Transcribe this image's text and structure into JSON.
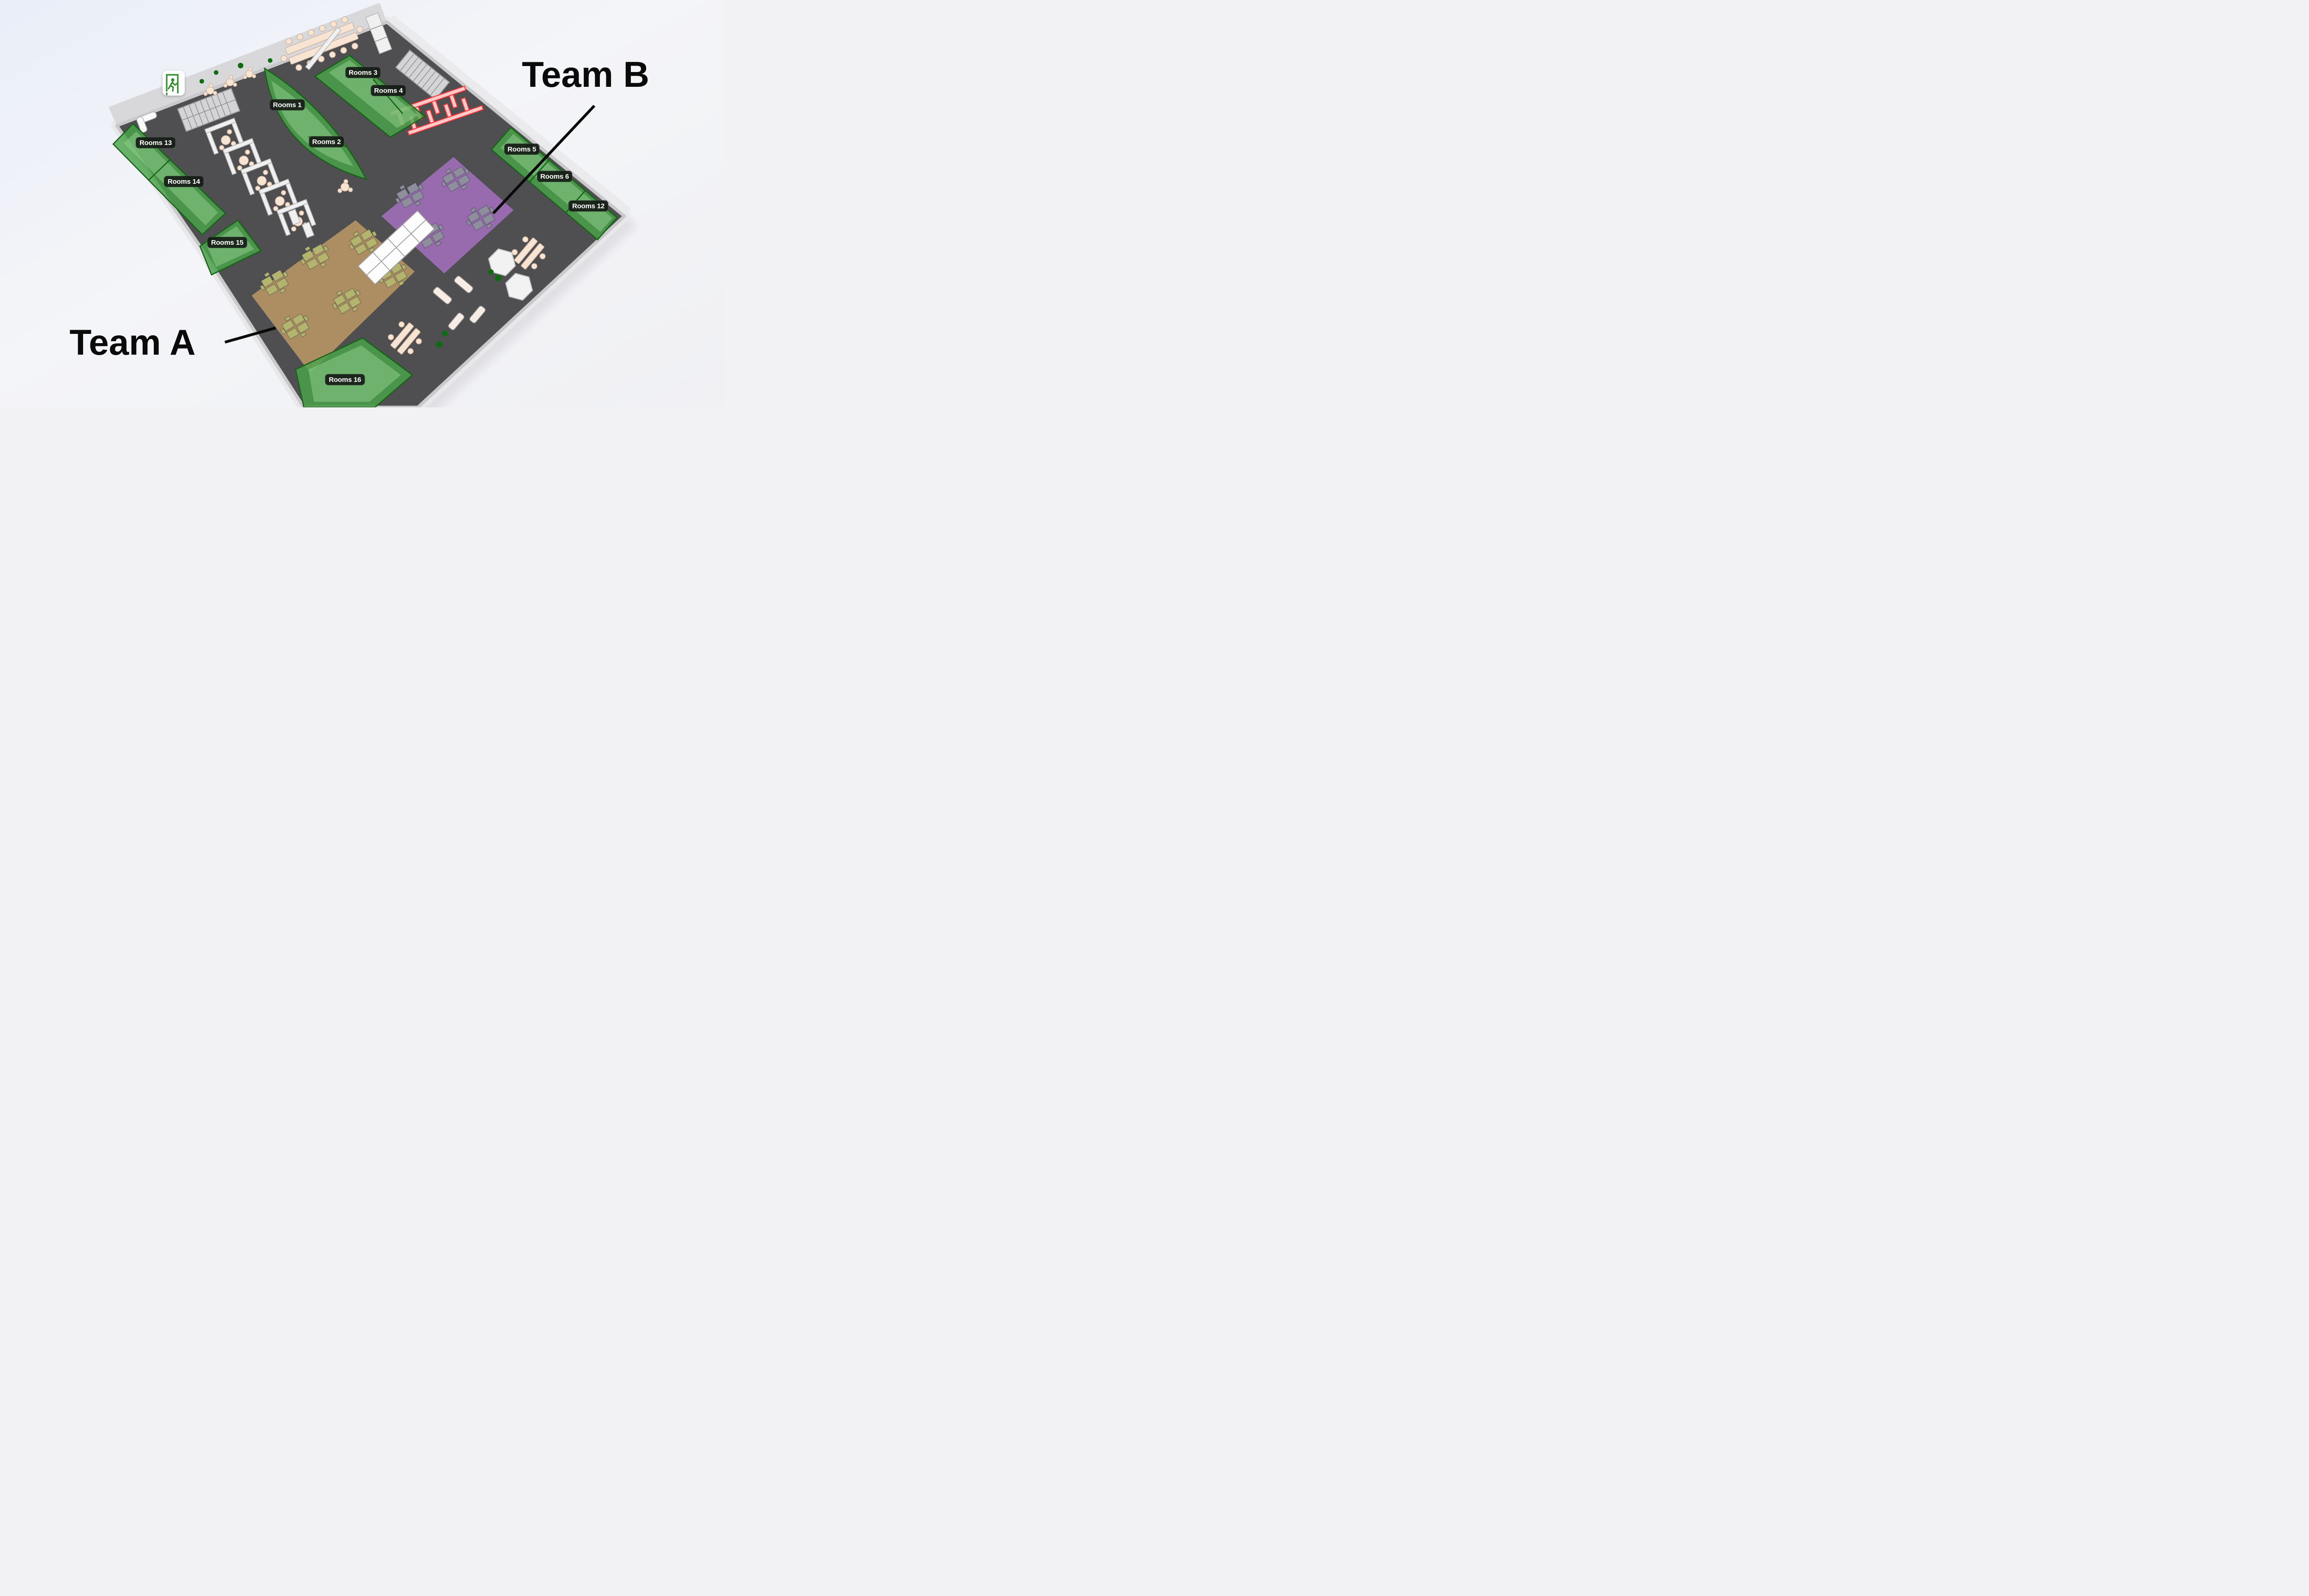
{
  "scene": {
    "title": "3D office floor plan",
    "view": "isometric"
  },
  "teams": {
    "a": {
      "label": "Team A"
    },
    "b": {
      "label": "Team B"
    }
  },
  "rooms": {
    "r1": {
      "label": "Rooms 1"
    },
    "r2": {
      "label": "Rooms 2"
    },
    "r3": {
      "label": "Rooms 3"
    },
    "r4": {
      "label": "Rooms 4"
    },
    "r5": {
      "label": "Rooms 5"
    },
    "r6": {
      "label": "Rooms 6"
    },
    "r12": {
      "label": "Rooms 12"
    },
    "r13": {
      "label": "Rooms 13"
    },
    "r14": {
      "label": "Rooms 14"
    },
    "r15": {
      "label": "Rooms 15"
    },
    "r16": {
      "label": "Rooms 16"
    }
  },
  "icons": {
    "exit": "emergency-exit-icon"
  },
  "colors": {
    "floor": "#4f4f51",
    "room_green": "#4aa44a",
    "zone_team_b_purple": "#9b6db3",
    "zone_team_a_tan": "#b29063",
    "highlight_red": "#ff3232",
    "desk_gray": "#8f8e9c",
    "desk_olive": "#b3b46e",
    "label_badge": "#171c17",
    "background": "#eef1f8"
  }
}
